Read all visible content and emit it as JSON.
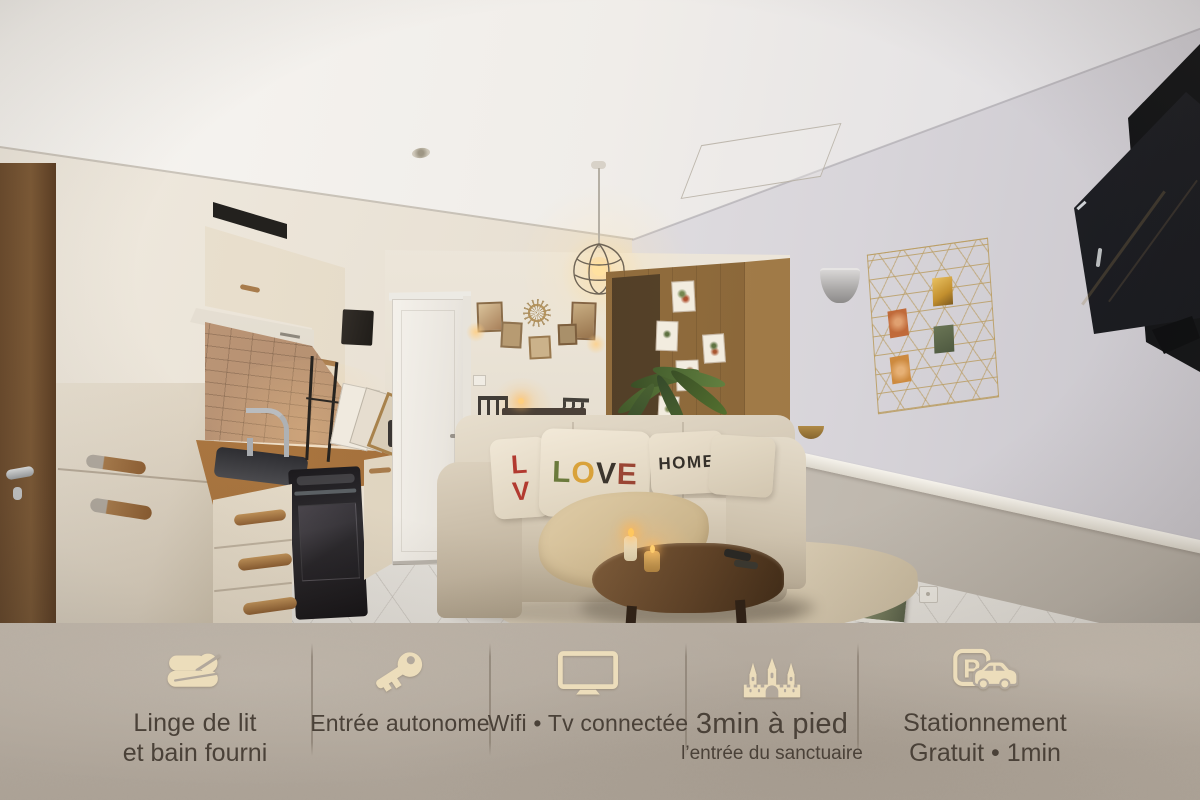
{
  "photo": {
    "pillows": {
      "left_letters": [
        {
          "ch": "L",
          "color": "#b23a30"
        },
        {
          "ch": "V",
          "color": "#b23a30"
        }
      ],
      "love_letters": [
        {
          "ch": "L",
          "color": "#6b7a3c"
        },
        {
          "ch": "O",
          "color": "#d9a23a"
        },
        {
          "ch": "V",
          "color": "#3b352d"
        },
        {
          "ch": "E",
          "color": "#9a4534"
        }
      ],
      "home_text": "HOME",
      "home_color": "#35302a"
    }
  },
  "banner": {
    "colors": {
      "background": "#b2a89c",
      "icon": "#ecddbb",
      "text": "#4a4138",
      "divider": "#8b8073"
    },
    "items": [
      {
        "icon": "towels-icon",
        "lines": [
          "Linge de lit",
          "et bain fourni"
        ]
      },
      {
        "icon": "key-icon",
        "lines": [
          "Entrée autonome"
        ]
      },
      {
        "icon": "tv-icon",
        "lines": [
          "Wifi • Tv connectée"
        ]
      },
      {
        "icon": "church-icon",
        "lines": [
          "3min à pied",
          "l’entrée du sanctuaire"
        ]
      },
      {
        "icon": "parking-icon",
        "lines": [
          "Stationnement",
          "Gratuit • 1min"
        ],
        "icon_letter": "P"
      }
    ]
  }
}
